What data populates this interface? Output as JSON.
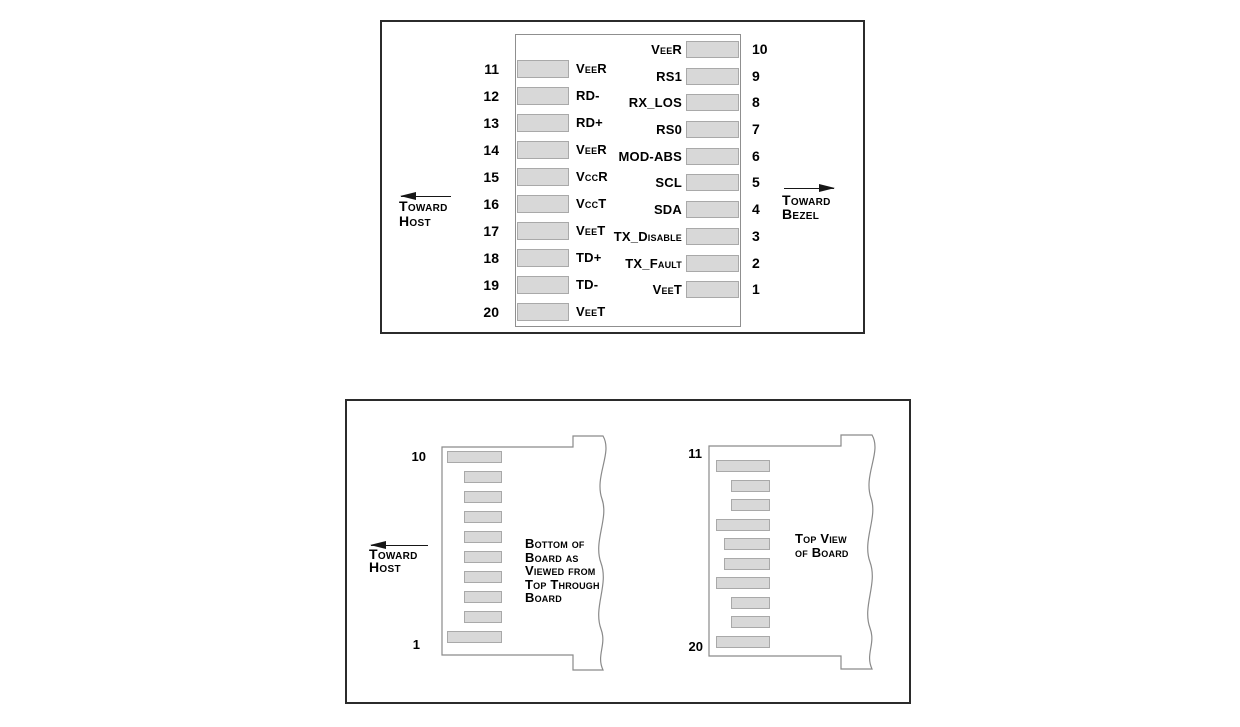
{
  "figure1": {
    "left_pins": [
      {
        "number": "11",
        "label": "VeeR"
      },
      {
        "number": "12",
        "label": "RD-"
      },
      {
        "number": "13",
        "label": "RD+"
      },
      {
        "number": "14",
        "label": "VeeR"
      },
      {
        "number": "15",
        "label": "VccR"
      },
      {
        "number": "16",
        "label": "VccT"
      },
      {
        "number": "17",
        "label": "VeeT"
      },
      {
        "number": "18",
        "label": "TD+"
      },
      {
        "number": "19",
        "label": "TD-"
      },
      {
        "number": "20",
        "label": "VeeT"
      }
    ],
    "right_pins": [
      {
        "number": "10",
        "label": "VeeR"
      },
      {
        "number": "9",
        "label": "RS1"
      },
      {
        "number": "8",
        "label": "RX_LOS"
      },
      {
        "number": "7",
        "label": "RS0"
      },
      {
        "number": "6",
        "label": "MOD-ABS"
      },
      {
        "number": "5",
        "label": "SCL"
      },
      {
        "number": "4",
        "label": "SDA"
      },
      {
        "number": "3",
        "label": "TX_Disable"
      },
      {
        "number": "2",
        "label": "TX_Fault"
      },
      {
        "number": "1",
        "label": "VeeT"
      }
    ],
    "toward_host": {
      "line1": "Toward",
      "line2": "Host"
    },
    "toward_bezel": {
      "line1": "Toward",
      "line2": "Bezel"
    }
  },
  "figure2": {
    "toward_host": {
      "line1": "Toward",
      "line2": "Host"
    },
    "left_board": {
      "top_pin": "10",
      "bottom_pin": "1",
      "caption": [
        "Bottom of",
        "Board as",
        "Viewed from",
        "Top Through",
        "Board"
      ]
    },
    "right_board": {
      "top_pin": "11",
      "bottom_pin": "20",
      "caption": [
        "Top View",
        "of Board"
      ]
    }
  },
  "colors": {
    "pad_fill": "#d8d8d8",
    "pad_border": "#a9a9a9",
    "board_outline": "#8a8a8a",
    "frame_border": "#2b2b2b",
    "text": "#000000"
  }
}
